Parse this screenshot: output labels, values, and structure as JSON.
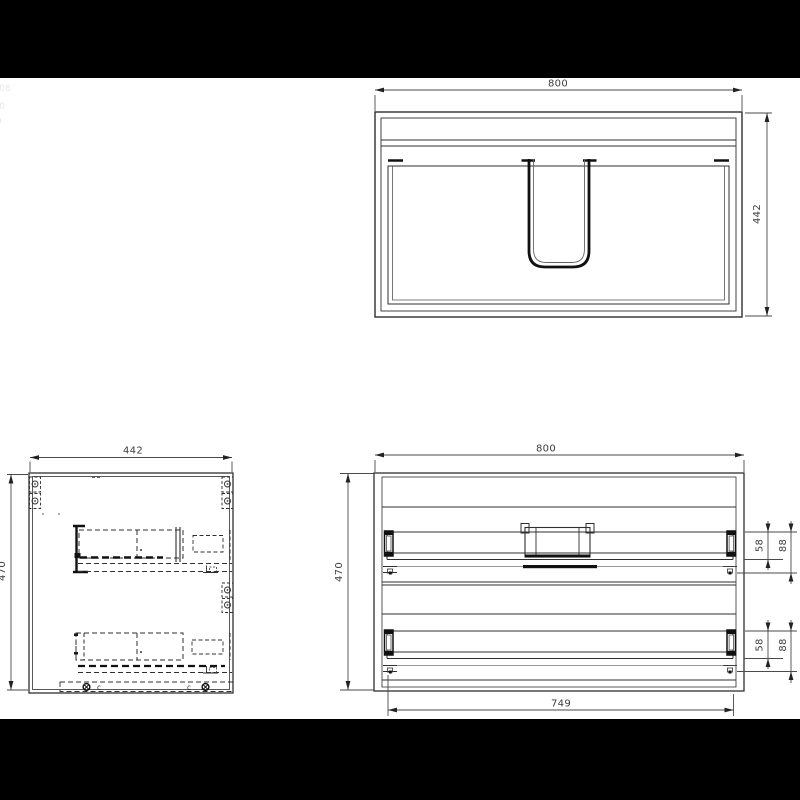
{
  "colors": {
    "background": "#ffffff",
    "black_bar": "#000000",
    "line": "#2f2f2f",
    "dim_text": "#3d3d3d"
  },
  "views": {
    "plan": {
      "width": "800",
      "depth": "442"
    },
    "side": {
      "depth": "442",
      "height": "470",
      "hardware_label_left": "c",
      "hardware_label_right": "c"
    },
    "back": {
      "width": "800",
      "height": "470",
      "drawer_span": "749",
      "slide_offset_upper": "58",
      "drawer_back_height_upper": "88",
      "slide_offset_lower": "58",
      "drawer_back_height_lower": "88"
    }
  },
  "artifacts": {
    "edge_fragments": [
      "-08",
      "-0",
      "0"
    ]
  }
}
